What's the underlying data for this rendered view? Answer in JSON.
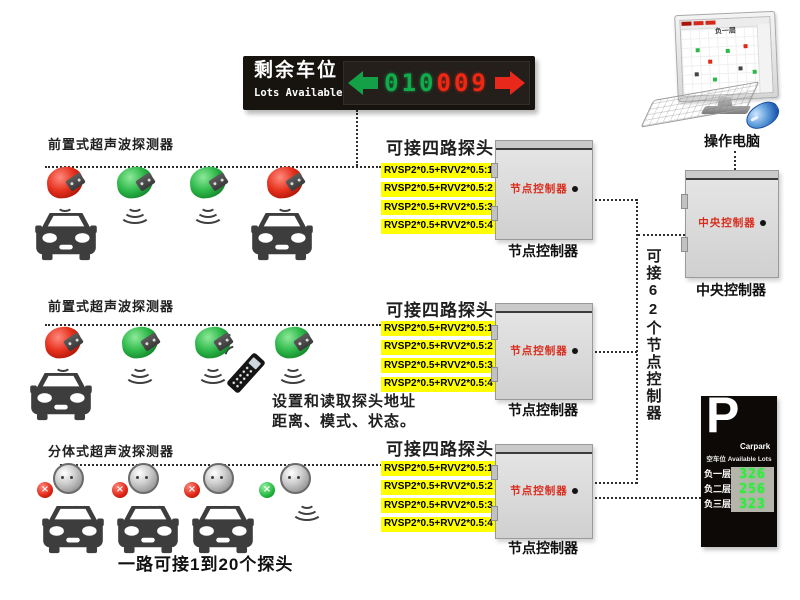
{
  "led_sign": {
    "title": "剩余车位",
    "subtitle": "Lots Available",
    "green_digits": "010",
    "red_digits": "009"
  },
  "computer": {
    "label": "操作电脑",
    "screen_label": "负一层"
  },
  "rows": [
    {
      "label": "前置式超声波探测器",
      "type": "front",
      "sensors": [
        "red",
        "green",
        "green",
        "red"
      ],
      "cars_under": [
        0,
        3
      ],
      "channel": {
        "heading": "可接四路探头",
        "lines": [
          "RVSP2*0.5+RVV2*0.5:1",
          "RVSP2*0.5+RVV2*0.5:2",
          "RVSP2*0.5+RVV2*0.5:3",
          "RVSP2*0.5+RVV2*0.5:4"
        ]
      },
      "node": {
        "panel_label": "节点控制器",
        "caption": "节点控制器"
      }
    },
    {
      "label": "前置式超声波探测器",
      "type": "front",
      "sensors": [
        "red",
        "green",
        "green",
        "green"
      ],
      "cars_under": [
        0
      ],
      "remote_note": [
        "设置和读取探头地址",
        "距离、模式、状态。"
      ],
      "channel": {
        "heading": "可接四路探头",
        "lines": [
          "RVSP2*0.5+RVV2*0.5:1",
          "RVSP2*0.5+RVV2*0.5:2",
          "RVSP2*0.5+RVV2*0.5:3",
          "RVSP2*0.5+RVV2*0.5:4"
        ]
      },
      "node": {
        "panel_label": "节点控制器",
        "caption": "节点控制器"
      }
    },
    {
      "label": "分体式超声波探测器",
      "type": "split",
      "sensors": [
        "red",
        "red",
        "red",
        "green"
      ],
      "cars_under": [
        0,
        1,
        2
      ],
      "caption": "一路可接1到20个探头",
      "channel": {
        "heading": "可接四路探头",
        "lines": [
          "RVSP2*0.5+RVV2*0.5:1",
          "RVSP2*0.5+RVV2*0.5:2",
          "RVSP2*0.5+RVV2*0.5:3",
          "RVSP2*0.5+RVV2*0.5:4"
        ]
      },
      "node": {
        "panel_label": "节点控制器",
        "caption": "节点控制器"
      }
    }
  ],
  "trunk_label": "可接62个节点控制器",
  "central": {
    "panel_label": "中央控制器",
    "caption": "中央控制器"
  },
  "parking_sign": {
    "big_letter": "P",
    "brand": "Carpark",
    "subtitle": "空车位 Available Lots",
    "floors": [
      {
        "label": "负一层",
        "value": "326"
      },
      {
        "label": "负二层",
        "value": "256"
      },
      {
        "label": "负三层",
        "value": "323"
      }
    ]
  },
  "colors": {
    "led_green": "#10ab4b",
    "led_red": "#ef2713",
    "highlight_yellow": "#ffff00",
    "controller_label_red": "#d92b1c"
  }
}
